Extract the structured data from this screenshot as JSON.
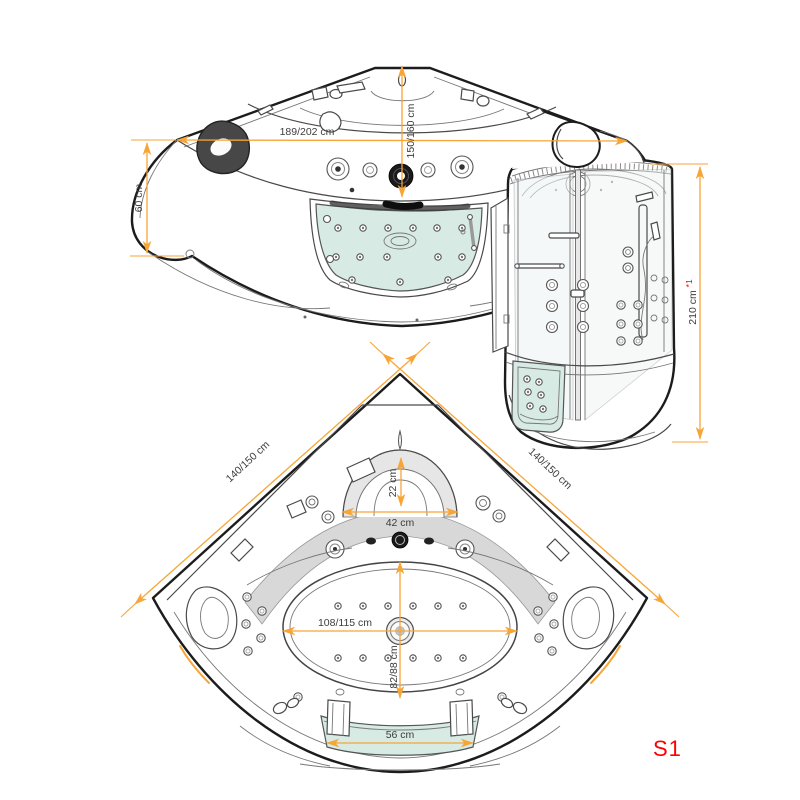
{
  "labels": {
    "variant": "S1"
  },
  "front_view": {
    "overall_width": "189/202 cm",
    "corner_depth": "150/160 cm",
    "apron_height": "60 cm"
  },
  "cabin_view": {
    "height": "210 cm",
    "height_footnote": "*1"
  },
  "plan_view": {
    "left_side": "140/150 cm",
    "right_side": "140/150 cm",
    "headrest_depth": "22 cm",
    "headrest_width": "42 cm",
    "basin_width": "108/115 cm",
    "basin_depth": "82/88 cm",
    "front_glass_width": "56 cm"
  },
  "colors": {
    "dimension_line": "#F7A537",
    "label_text": "#3C3C3C",
    "accent_red": "#FF0000",
    "glass_tint": "#D7EBE4"
  }
}
